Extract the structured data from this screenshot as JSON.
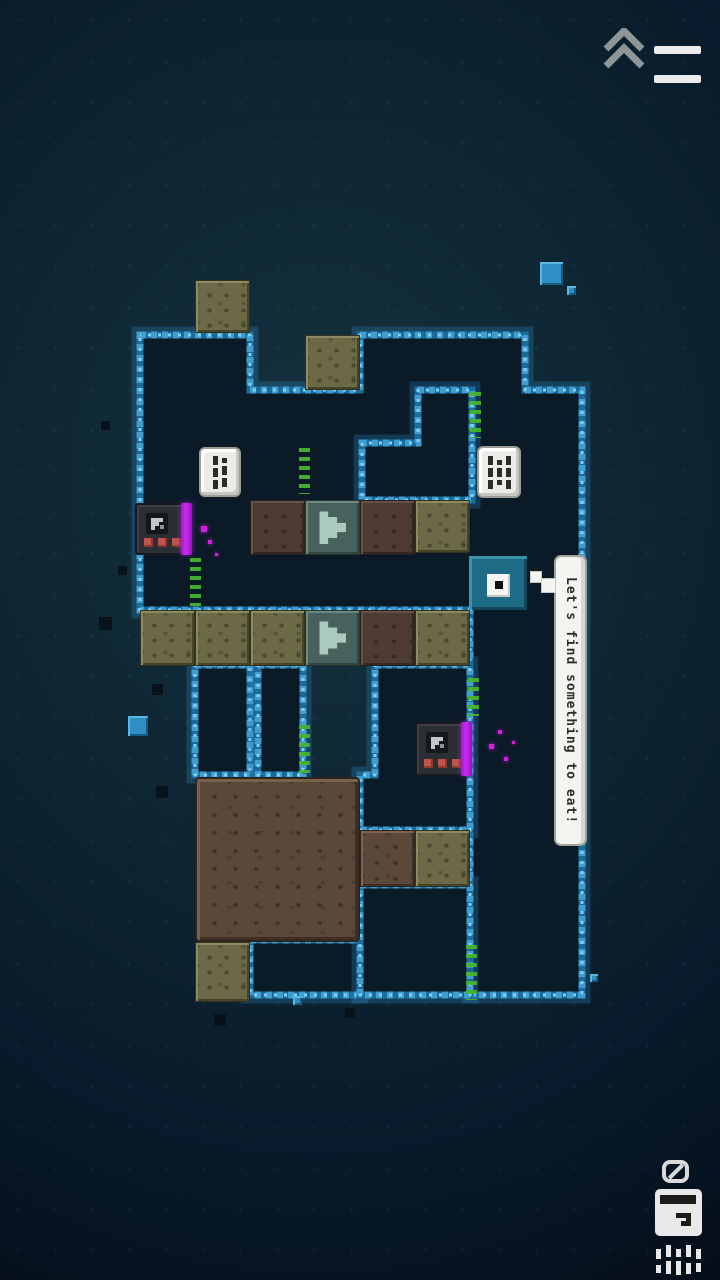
{
  "app": {
    "name": "Cave puzzle game"
  },
  "hud": {
    "collapse_button": {
      "icon": "double-chevron-up"
    },
    "menu_button": {
      "icon": "hamburger-two-bars"
    },
    "objective": {
      "ban_icon": "no-symbol",
      "item_icon": "fridge-box",
      "trail_icon": "dashed-trail",
      "trail_bars": [
        {
          "x": 0,
          "y": 4,
          "w": 5,
          "h": 10
        },
        {
          "x": 0,
          "y": 20,
          "w": 5,
          "h": 8
        },
        {
          "x": 10,
          "y": 0,
          "w": 5,
          "h": 12
        },
        {
          "x": 10,
          "y": 16,
          "w": 5,
          "h": 13
        },
        {
          "x": 20,
          "y": 4,
          "w": 5,
          "h": 8
        },
        {
          "x": 20,
          "y": 16,
          "w": 5,
          "h": 14
        },
        {
          "x": 30,
          "y": 0,
          "w": 5,
          "h": 12
        },
        {
          "x": 30,
          "y": 18,
          "w": 5,
          "h": 11
        },
        {
          "x": 40,
          "y": 4,
          "w": 5,
          "h": 10
        },
        {
          "x": 40,
          "y": 18,
          "w": 5,
          "h": 9
        }
      ]
    }
  },
  "speech_bubble": {
    "text": "Let's find something to eat!",
    "x": 554,
    "y": 555,
    "w": 33,
    "h": 291,
    "tail": [
      {
        "x": 530,
        "y": 571,
        "s": 12
      },
      {
        "x": 541,
        "y": 578,
        "s": 15
      }
    ]
  },
  "level": {
    "cave_paths": [
      {
        "name": "main-cavern",
        "d": "M140 335H250V390H360V335H525V390H582V995H470V610H140Z"
      },
      {
        "name": "rock-pillar",
        "d": "M418 390H472V500H362V443H418Z"
      },
      {
        "name": "creature-pocket",
        "d": "M375 665H470V830H360V775H375Z"
      },
      {
        "name": "shaft-left",
        "d": "M195 665H250V775H195Z"
      },
      {
        "name": "shaft-right",
        "d": "M258 665H303V775H258Z"
      },
      {
        "name": "bottom-pocket",
        "d": "M250 940H360V995H250Z"
      },
      {
        "name": "bottom-right-pocket",
        "d": "M360 885H470V995H360Z"
      }
    ],
    "tiles": [
      {
        "x": 195,
        "y": 280,
        "w": 55,
        "h": 53,
        "type": "khaki"
      },
      {
        "x": 305,
        "y": 335,
        "w": 55,
        "h": 55,
        "type": "khaki"
      },
      {
        "x": 250,
        "y": 500,
        "w": 55,
        "h": 55,
        "type": "browndark"
      },
      {
        "x": 305,
        "y": 500,
        "w": 55,
        "h": 55,
        "type": "arrow"
      },
      {
        "x": 360,
        "y": 500,
        "w": 55,
        "h": 55,
        "type": "browndark"
      },
      {
        "x": 415,
        "y": 500,
        "w": 55,
        "h": 53,
        "type": "khaki"
      },
      {
        "x": 140,
        "y": 610,
        "w": 55,
        "h": 56,
        "type": "khaki"
      },
      {
        "x": 195,
        "y": 610,
        "w": 55,
        "h": 56,
        "type": "khaki"
      },
      {
        "x": 250,
        "y": 610,
        "w": 55,
        "h": 56,
        "type": "khaki"
      },
      {
        "x": 305,
        "y": 610,
        "w": 55,
        "h": 56,
        "type": "arrow"
      },
      {
        "x": 360,
        "y": 610,
        "w": 55,
        "h": 56,
        "type": "browndark"
      },
      {
        "x": 415,
        "y": 610,
        "w": 55,
        "h": 56,
        "type": "khaki"
      },
      {
        "x": 195,
        "y": 777,
        "w": 165,
        "h": 165,
        "type": "brownmass"
      },
      {
        "x": 360,
        "y": 830,
        "w": 55,
        "h": 57,
        "type": "brown"
      },
      {
        "x": 415,
        "y": 830,
        "w": 55,
        "h": 57,
        "type": "khaki"
      },
      {
        "x": 195,
        "y": 942,
        "w": 55,
        "h": 60,
        "type": "khaki"
      }
    ],
    "dice": [
      {
        "x": 199,
        "y": 447,
        "w": 42,
        "h": 50,
        "marks": [
          [
            "d",
            "d",
            "d"
          ],
          [
            "o",
            "d",
            "d"
          ]
        ]
      },
      {
        "x": 477,
        "y": 446,
        "w": 44,
        "h": 52,
        "marks": [
          [
            "d",
            "d",
            "d"
          ],
          [
            "o",
            "d",
            "o"
          ],
          [
            "d",
            "d",
            "d"
          ]
        ]
      }
    ],
    "creatures": [
      {
        "x": 135,
        "y": 503,
        "w": 48,
        "h": 52
      },
      {
        "x": 415,
        "y": 722,
        "w": 48,
        "h": 54
      }
    ],
    "player": {
      "x": 469,
      "y": 556,
      "w": 58,
      "h": 54
    },
    "grass": [
      {
        "x": 470,
        "y": 392,
        "h": 46
      },
      {
        "x": 299,
        "y": 448,
        "h": 46
      },
      {
        "x": 190,
        "y": 558,
        "h": 48
      },
      {
        "x": 299,
        "y": 725,
        "h": 48
      },
      {
        "x": 466,
        "y": 945,
        "h": 55
      },
      {
        "x": 468,
        "y": 678,
        "h": 38
      }
    ],
    "magenta_particles": [
      {
        "x": 201,
        "y": 526,
        "s": 6
      },
      {
        "x": 208,
        "y": 540,
        "s": 4
      },
      {
        "x": 215,
        "y": 553,
        "s": 3
      },
      {
        "x": 489,
        "y": 744,
        "s": 5
      },
      {
        "x": 498,
        "y": 730,
        "s": 4
      },
      {
        "x": 504,
        "y": 757,
        "s": 4
      },
      {
        "x": 512,
        "y": 741,
        "s": 3
      }
    ],
    "cyan_squares": [
      {
        "x": 540,
        "y": 262,
        "s": 23
      },
      {
        "x": 567,
        "y": 286,
        "s": 9
      },
      {
        "x": 128,
        "y": 716,
        "s": 20
      },
      {
        "x": 293,
        "y": 996,
        "s": 9
      },
      {
        "x": 590,
        "y": 974,
        "s": 8
      }
    ],
    "dark_squares": [
      {
        "x": 99,
        "y": 617,
        "s": 13
      },
      {
        "x": 152,
        "y": 684,
        "s": 11
      },
      {
        "x": 156,
        "y": 786,
        "s": 12
      },
      {
        "x": 214,
        "y": 1014,
        "s": 12
      },
      {
        "x": 345,
        "y": 1008,
        "s": 10
      },
      {
        "x": 101,
        "y": 421,
        "s": 9
      },
      {
        "x": 118,
        "y": 566,
        "s": 9
      }
    ]
  },
  "colors": {
    "cave_fill": "#0a1a27",
    "border_base": "#1d6b9b",
    "border_mid": "#3f9dcf",
    "border_bright": "#7ed2f4",
    "purple_strip": "#b81de4",
    "magenta_particle": "#d31fe0",
    "grass_green": "#45b42d",
    "player_teal": "#1e6b85"
  }
}
